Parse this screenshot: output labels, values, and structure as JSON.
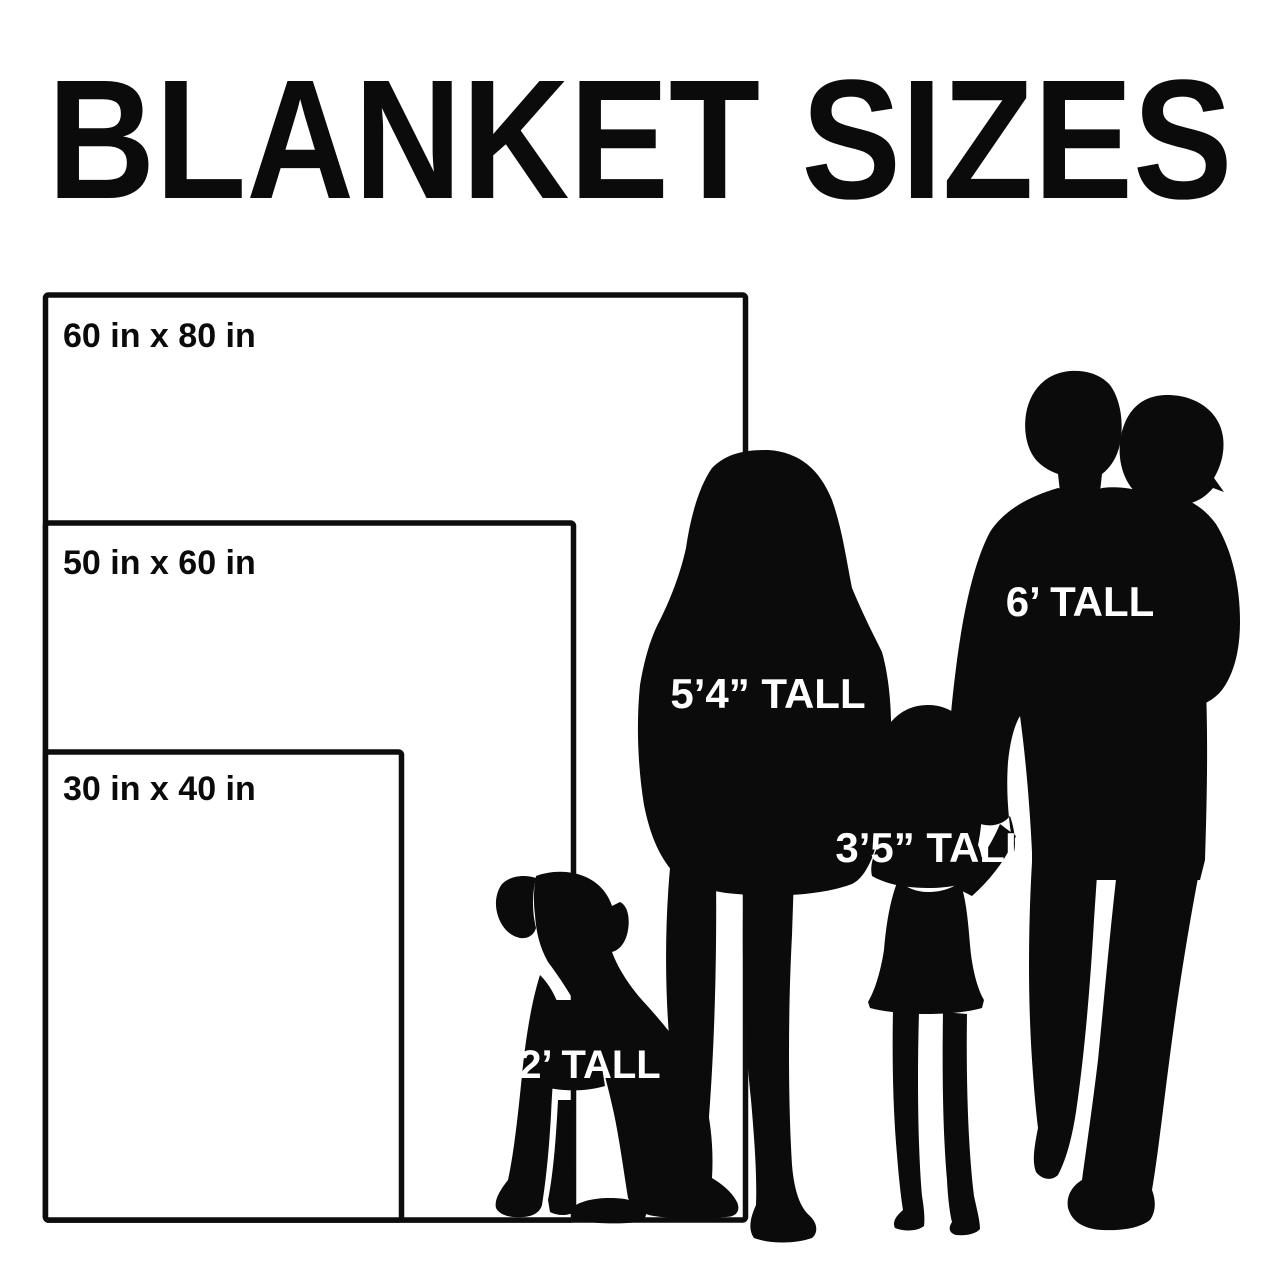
{
  "title": "BLANKET SIZES",
  "colors": {
    "background": "#ffffff",
    "ink": "#0b0b0b",
    "outline": "#0d0d0d",
    "label_on_dark": "#ffffff"
  },
  "blankets": [
    {
      "label": "60 in x 80 in",
      "width_in": 60,
      "height_in": 80
    },
    {
      "label": "50 in x 60 in",
      "width_in": 50,
      "height_in": 60
    },
    {
      "label": "30 in x 40 in",
      "width_in": 30,
      "height_in": 40
    }
  ],
  "figures": [
    {
      "name": "woman",
      "label": "5’4” TALL",
      "height": "5 ft 4 in"
    },
    {
      "name": "man",
      "label": "6’ TALL",
      "height": "6 ft"
    },
    {
      "name": "child",
      "label": "3’5” TALL",
      "height": "3 ft 5 in"
    },
    {
      "name": "dog",
      "label": "2’ TALL",
      "height": "2 ft"
    }
  ]
}
